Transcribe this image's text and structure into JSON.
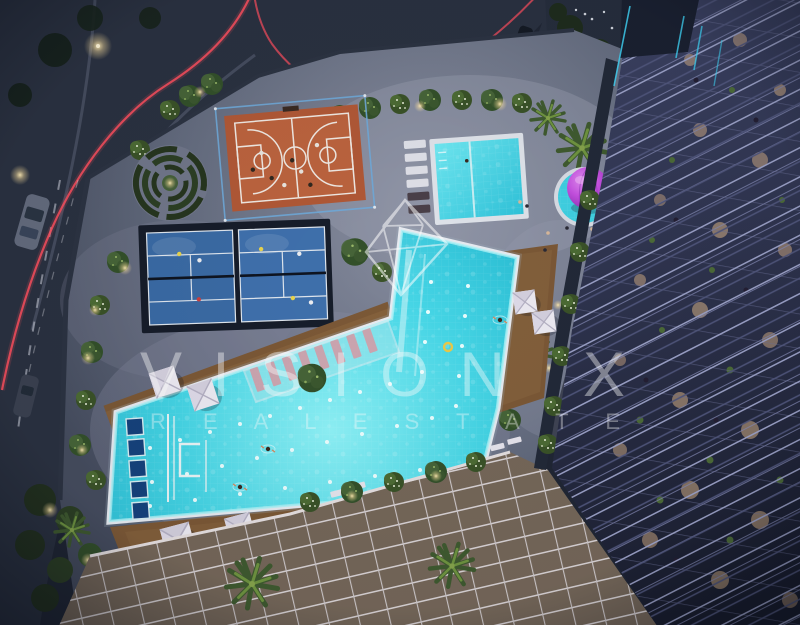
{
  "watermark": {
    "line1": "VISION X",
    "line2": "R E A L   E S T A T E",
    "logo": "diamond-gem"
  },
  "palette": {
    "pool_water": "#46d6e6",
    "pool_water_light": "#8ff2f7",
    "pool_water_deep": "#1cb2cc",
    "kids_pool_light": "#6fe8f2",
    "kids_pool_deep": "#2fc3da",
    "basketball_court": "#b05836",
    "padel_court_1": "#3a6aa4",
    "padel_court_2": "#3f70ac",
    "maze_hedge": "#26351f",
    "wood_deck": "#7b5836",
    "pavement": "#5c6476",
    "asphalt": "#232936",
    "umbrella_purple": "#c550e0",
    "umbrella_purple_deep": "#7c2aa8",
    "cabana_white": "#eceaf2",
    "lounger_pink": "#d79aa4",
    "light_trail_red": "#ff4f5e",
    "facade_frame": "#9aa0c6",
    "facade_warm": "#d9b287",
    "neon_cyan": "#3fd2f5",
    "watermark_white": "#ffffff"
  }
}
